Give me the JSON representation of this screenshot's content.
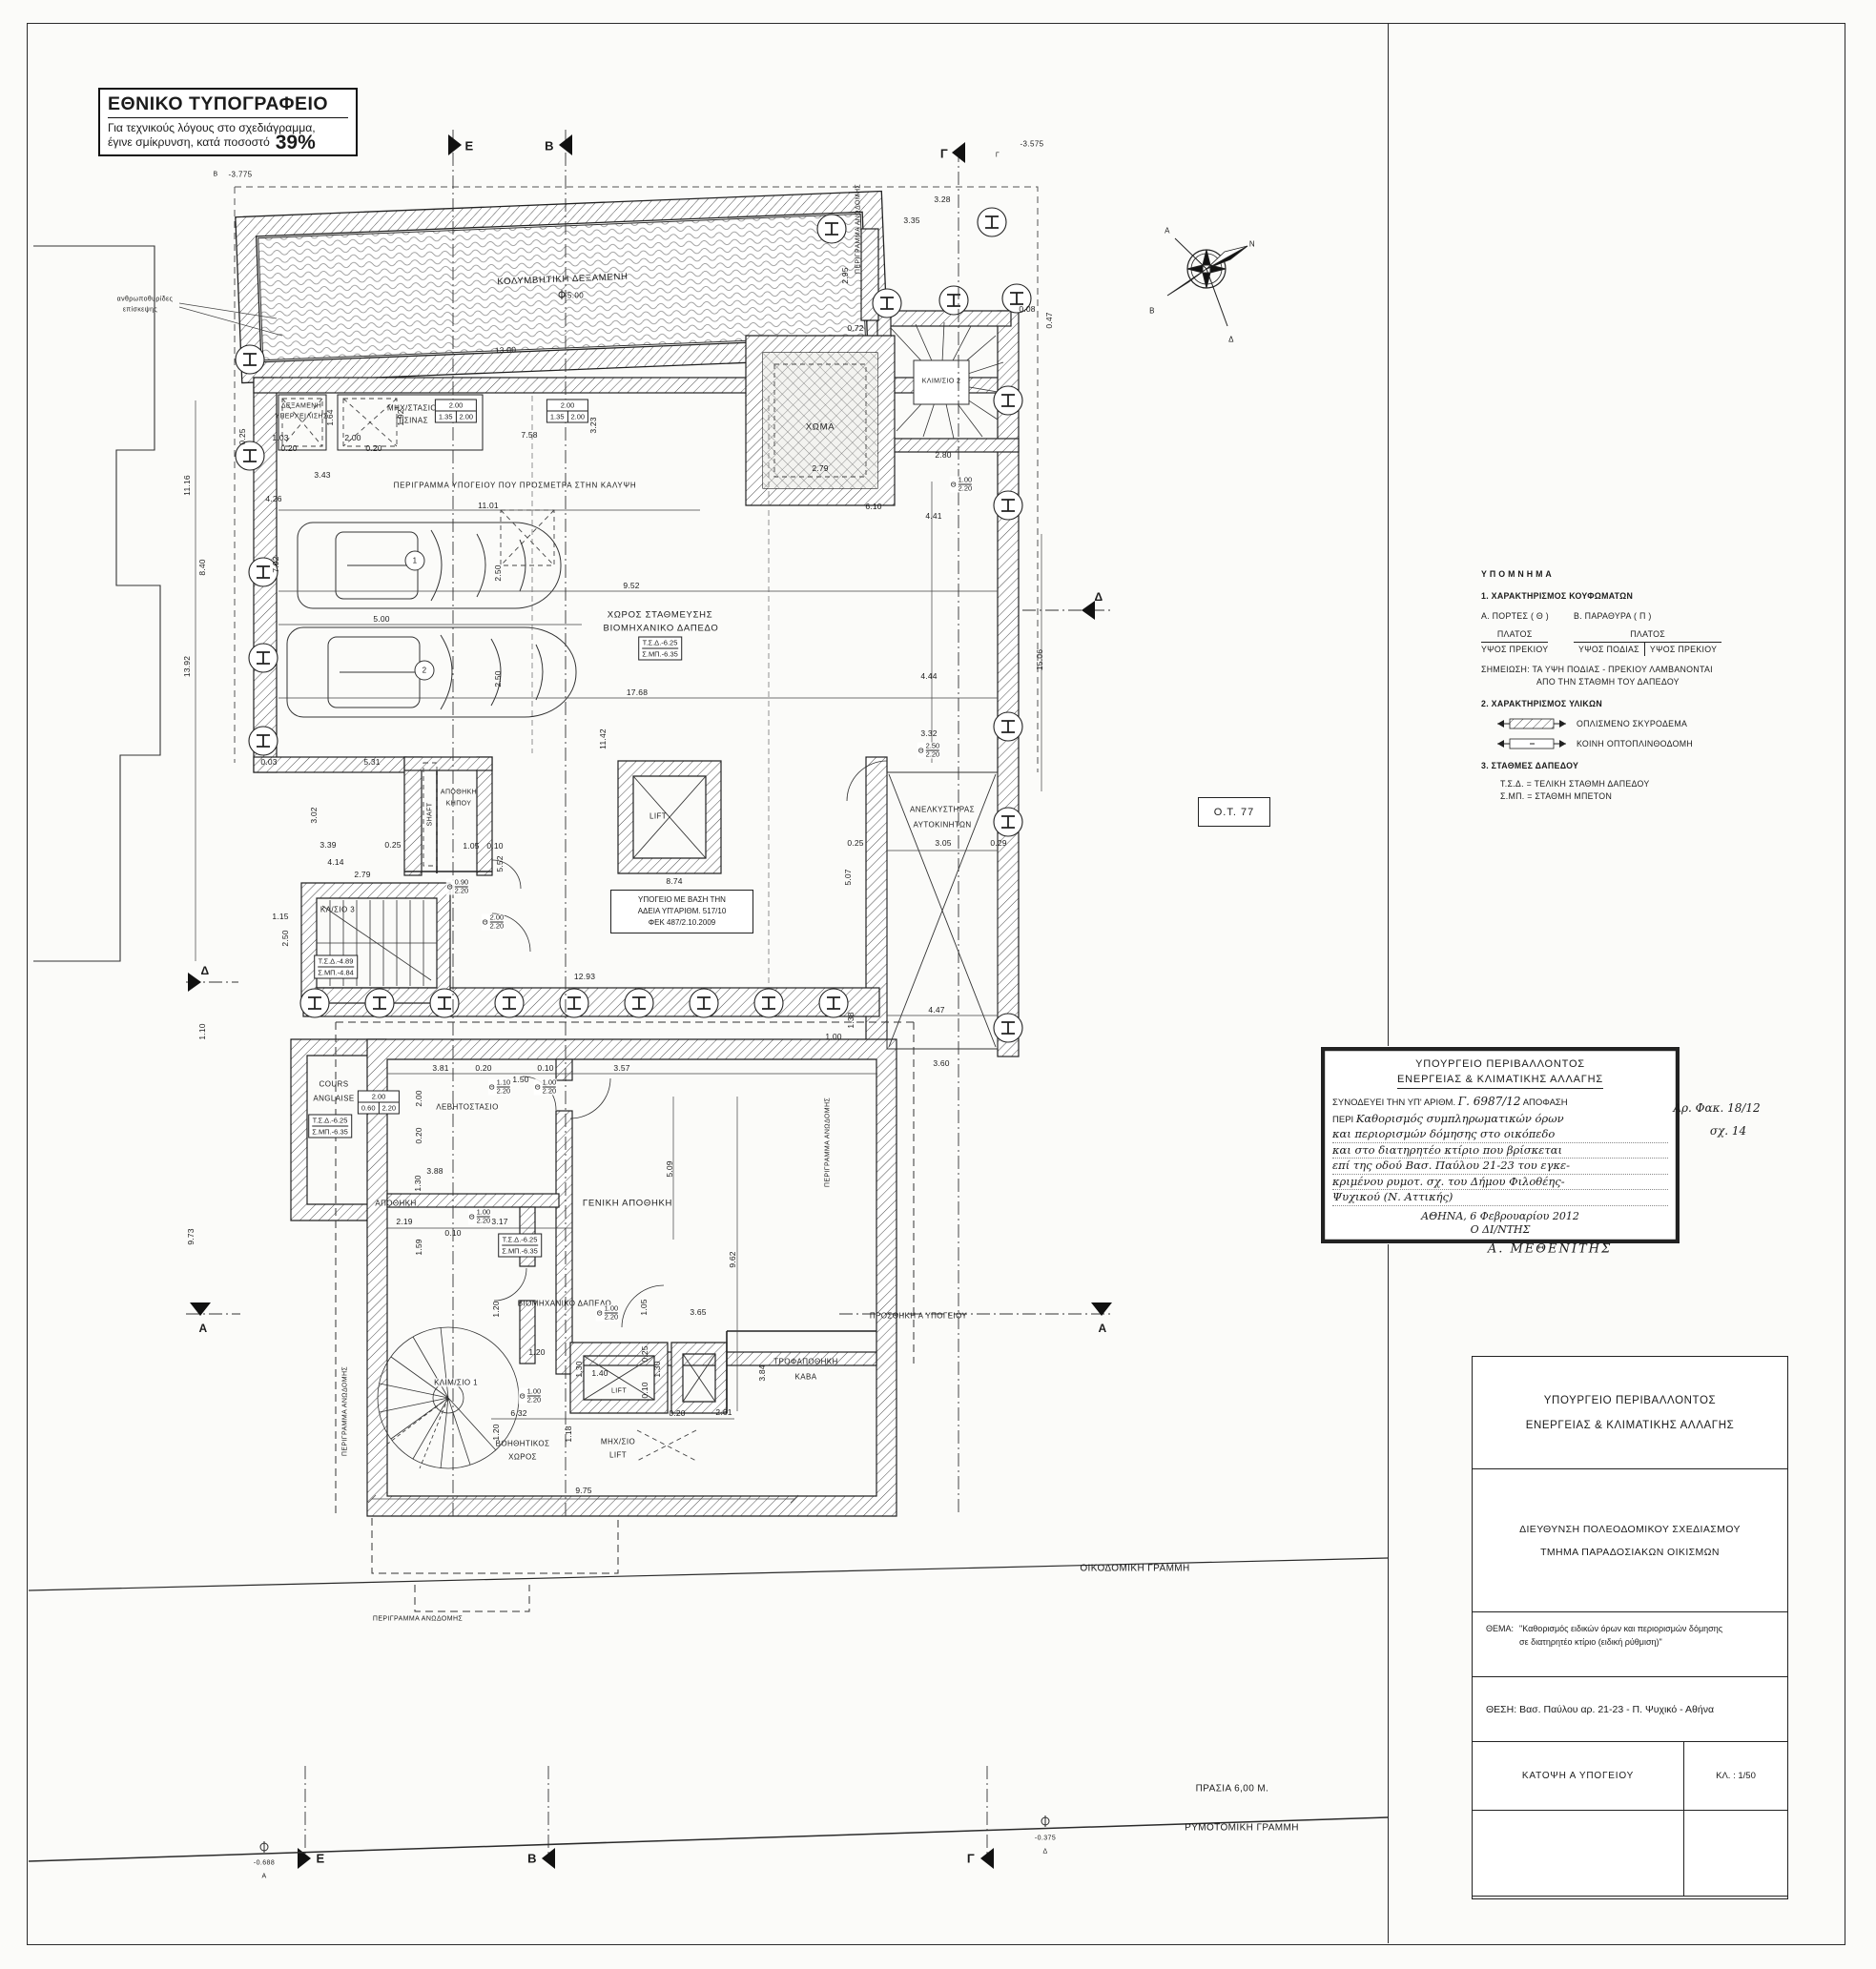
{
  "colors": {
    "ink": "#1f1f1f",
    "paper": "#fbfbf9"
  },
  "printshop": {
    "title": "ΕΘΝΙΚΟ ΤΥΠΟΓΡΑΦΕΙΟ",
    "line1": "Για τεχνικούς λόγους στο σχεδιάγραμμα,",
    "line2": "έγινε σμίκρυνση, κατά ποσοστό",
    "percent": "39%"
  },
  "compass": {
    "n": "Ν",
    "a": "Α",
    "b": "Β",
    "d": "Δ"
  },
  "block_label": "Ο.Τ. 77",
  "file_ref": {
    "folder": "Αρ. Φακ. 18/12",
    "sheet": "σχ. 14",
    "signature": "Α. ΜΕΘΕΝΙΤΗΣ"
  },
  "legend": {
    "title": "ΥΠΟΜΝΗΜΑ",
    "s1": "1. ΧΑΡΑΚΤΗΡΙΣΜΟΣ ΚΟΥΦΩΜΑΤΩΝ",
    "doors_h": "Α. ΠΟΡΤΕΣ ( Θ )",
    "windows_h": "Β. ΠΑΡΑΘΥΡΑ ( Π )",
    "platos": "ΠΛΑΤΟΣ",
    "ypsos_prekiou": "ΥΨΟΣ ΠΡΕΚΙΟΥ",
    "ypsos_podias": "ΥΨΟΣ ΠΟΔΙΑΣ",
    "note1": "ΣΗΜΕΙΩΣΗ: ΤΑ ΥΨΗ ΠΟΔΙΑΣ - ΠΡΕΚΙΟΥ ΛΑΜΒΑΝΟΝΤΑΙ",
    "note2": "ΑΠΟ ΤΗΝ  ΣΤΑΘΜΗ ΤΟΥ ΔΑΠΕΔΟΥ",
    "s2": "2. ΧΑΡΑΚΤΗΡΙΣΜΟΣ ΥΛΙΚΩΝ",
    "mat1": "ΟΠΛΙΣΜΕΝΟ ΣΚΥΡΟΔΕΜΑ",
    "mat2": "ΚΟΙΝΗ ΟΠΤΟΠΛΙΝΘΟΔΟΜΗ",
    "s3": "3. ΣΤΑΘΜΕΣ ΔΑΠΕΔΟΥ",
    "lvl1": "Τ.Σ.Δ.  =   ΤΕΛΙΚΗ ΣΤΑΘΜΗ ΔΑΠΕΔΟΥ",
    "lvl2": "Σ.ΜΠ.  =   ΣΤΑΘΜΗ ΜΠΕΤΟΝ"
  },
  "stamp": {
    "l1": "ΥΠΟΥΡΓΕΙΟ  ΠΕΡΙΒΑΛΛΟΝΤΟΣ",
    "l2": "ΕΝΕΡΓΕΙΑΣ & ΚΛΙΜΑΤΙΚΗΣ ΑΛΛΑΓΗΣ",
    "pre": "ΣΥΝΟΔΕΥΕΙ ΤΗΝ ΥΠ' ΑΡΙΘΜ.",
    "num": "Γ. 6987/12",
    "post": "ΑΠΟΦΑΣΗ",
    "peri": "ΠΕΡΙ",
    "hw1": "Καθορισμός συμπληρωματικών όρων",
    "hw2": "και περιορισμών δόμησης στο οικόπεδο",
    "hw3": "και στο διατηρητέο κτίριο που βρίσκεται",
    "hw4": "επί της οδού Βασ. Παύλου 21-23 του εγκε-",
    "hw5": "κριμένου ρυμοτ. σχ. του Δήμου Φιλοθέης-",
    "hw6": "Ψυχικού (Ν. Αττικής)",
    "date": "ΑΘΗΝΑ, 6 Φεβρουαρίου 2012",
    "role": "Ο ΔΙ/ΝΤΗΣ"
  },
  "titleblock": {
    "org1": "ΥΠΟΥΡΓΕΙΟ ΠΕΡΙΒΑΛΛΟΝΤΟΣ",
    "org2": "ΕΝΕΡΓΕΙΑΣ & ΚΛΙΜΑΤΙΚΗΣ ΑΛΛΑΓΗΣ",
    "dir1": "ΔΙΕΥΘΥΝΣΗ ΠΟΛΕΟΔΟΜΙΚΟΥ ΣΧΕΔΙΑΣΜΟΥ",
    "dir2": "ΤΜΗΜΑ ΠΑΡΑΔΟΣΙΑΚΩΝ ΟΙΚΙΣΜΩΝ",
    "thema_label": "ΘΕΜΑ:",
    "thema1": "\"Καθορισμός ειδικών όρων και περιορισμών δόμησης",
    "thema2": "σε διατηρητέο κτίριο (ειδική ρύθμιση)\"",
    "thesi_label": "ΘΕΣΗ:",
    "thesi": "Βασ. Παύλου αρ. 21-23  -  Π. Ψυχικό  -  Αθήνα",
    "drawing": "ΚΑΤΟΨΗ Α ΥΠΟΓΕΙΟΥ",
    "scale_label": "ΚΛ. : 1/50"
  },
  "plan": {
    "rooms": {
      "pool": "ΚΟΛΥΜΒΗΤΙΚΗ ΔΕΞΑΜΕΝΗ",
      "pool_lvl": "-5.00",
      "tank1": "ΔΕΞΑΜΕΝΗ",
      "tank2": "ΥΠΕΡΧΕΙΛΙΣΗΣ",
      "mech1": "ΜΗΧ/ΣΤΑΣΙΟ",
      "mech2": "ΠΙΣΙΝΑΣ",
      "soil": "ΧΩΜΑ",
      "stair2": "ΚΛΙΜ/ΣΙΟ 2",
      "parking1": "ΧΩΡΟΣ ΣΤΑΘΜΕΥΣΗΣ",
      "parking2": "ΒΙΟΜΗΧΑΝΙΚΟ ΔΑΠΕΔΟ",
      "lift": "LIFT",
      "carlift1": "ΑΝΕΛΚΥΣΤΗΡΑΣ",
      "carlift2": "ΑΥΤΟΚΙΝΗΤΩΝ",
      "garden1": "ΑΠΟΘΗΚΗ",
      "garden2": "ΚΗΠΟΥ",
      "shaft": "SHAFT",
      "stair3": "ΚΛ/ΣΙΟ 3",
      "cours1": "COURS",
      "cours2": "ANGLAISE",
      "boiler": "ΛΕΒΗΤΟΣΤΑΣΙΟ",
      "storage": "ΑΠΟΘΗΚΗ",
      "general": "ΓΕΝΙΚΗ ΑΠΟΘΗΚΗ",
      "indfloor": "ΒΙΟΜΗΧΑΝΙΚΟ ΔΑΠΕΔΟ",
      "stair1": "ΚΛΙΜ/ΣΙΟ 1",
      "pantry1": "ΤΡΟΦΑΠΟΘΗΚΗ",
      "pantry2": "ΚΑΒΑ",
      "aux1": "ΒΟΗΘΗΤΙΚΟΣ",
      "aux2": "ΧΩΡΟΣ",
      "mlift1": "ΜΗΧ/ΣΙΟ",
      "mlift2": "LIFT"
    },
    "levels": {
      "tsd625": "Τ.Σ.Δ.-6.25",
      "smp635": "Σ.ΜΠ.-6.35",
      "tsd489": "Τ.Σ.Δ.-4.89",
      "smp484": "Σ.ΜΠ.-4.84"
    },
    "notes": {
      "permit1": "ΥΠΟΓΕΙΟ ΜΕ ΒΑΣΗ ΤΗΝ",
      "permit2": "ΑΔΕΙΑ ΥΠ'ΑΡΙΘΜ. 517/10",
      "permit3": "ΦΕΚ 487/2.10.2009",
      "outline_cover": "ΠΕΡΙΓΡΑΜΜΑ ΥΠΟΓΕΙΟΥ ΠΟΥ ΠΡΟΣΜΕΤΡΑ ΣΤΗΝ ΚΑΛΥΨΗ",
      "outline_super": "ΠΕΡΙΓΡΑΜΜΑ ΑΝΩΔΟΜΗΣ",
      "addition": "ΠΡΟΣΘΗΚΗ Α ΥΠΟΓΕΙΟΥ",
      "manholes1": "ανθρωποθυρίδες",
      "manholes2": "επίσκεψης"
    },
    "site": {
      "building_line": "ΟΙΚΟΔΟΜΙΚΗ ΓΡΑΜΜΗ",
      "setback": "ΠΡΑΣΙΑ 6,00 Μ.",
      "street_line": "ΡΥΜΟΤΟΜΙΚΗ ΓΡΑΜΜΗ",
      "lvl_a": "-0.688",
      "lvl_d": "-0.375",
      "b_lvl": "-3.775",
      "g_lvl": "-3.575"
    },
    "sections": {
      "e": "Ε",
      "b": "Β",
      "g": "Γ",
      "a": "Α",
      "d": "Δ"
    },
    "spots": {
      "s1": "1",
      "s2": "2"
    },
    "doors": [
      {
        "k": "Θ",
        "w": "1.00",
        "h": "2.20"
      },
      {
        "k": "Θ",
        "w": "2.50",
        "h": "2.20"
      },
      {
        "k": "Θ",
        "w": "0.90",
        "h": "2.20"
      },
      {
        "k": "Θ",
        "w": "2.00",
        "h": "2.20"
      },
      {
        "k": "Θ",
        "w": "1.10",
        "h": "2.20"
      },
      {
        "k": "Θ",
        "w": "1.00",
        "h": "2.20"
      },
      {
        "k": "Θ",
        "w": "1.00",
        "h": "2.20"
      },
      {
        "k": "Θ",
        "w": "1.00",
        "h": "2.20"
      },
      {
        "k": "Θ",
        "w": "1.00",
        "h": "2.20"
      }
    ],
    "winboxes": [
      {
        "t": "2.00",
        "a": "1.35",
        "b": "2.00"
      },
      {
        "t": "2.00",
        "a": "1.35",
        "b": "2.00"
      },
      {
        "t": "2.00",
        "a": "0.60",
        "b": "2.20"
      }
    ],
    "dims": [
      "3.43",
      "4.26",
      "11.01",
      "9.52",
      "5.00",
      "17.68",
      "11.42",
      "7.92",
      "5.31",
      "0.03",
      "7.58",
      "13.00",
      "1.92",
      "0.25",
      "3.23",
      "3.28",
      "3.35",
      "0.72",
      "2.95",
      "0.08",
      "0.47",
      "2.80",
      "6.10",
      "4.41",
      "15.06",
      "4.44",
      "3.32",
      "3.02",
      "3.39",
      "0.25",
      "4.14",
      "2.79",
      "1.15",
      "2.50",
      "1.05",
      "0.10",
      "5.52",
      "8.74",
      "12.93",
      "0.25",
      "3.05",
      "0.29",
      "5.07",
      "4.47",
      "3.60",
      "1.38",
      "1.00",
      "2.79",
      "3.81",
      "0.20",
      "0.10",
      "3.57",
      "1.50",
      "2.00",
      "0.20",
      "3.88",
      "1.30",
      "2.19",
      "3.17",
      "0.10",
      "1.59",
      "5.09",
      "9.62",
      "1.20",
      "1.05",
      "3.65",
      "1.20",
      "1.40",
      "1.30",
      "1.30",
      "0.25",
      "0.10",
      "3.84",
      "6.32",
      "0.20",
      "2.61",
      "1.20",
      "1.18",
      "9.75",
      "9.73",
      "1.10",
      "11.16",
      "8.40",
      "13.92",
      "2.50",
      "2.50",
      "2.00",
      "0.20",
      "1.03",
      "0.20",
      "1.64"
    ]
  }
}
